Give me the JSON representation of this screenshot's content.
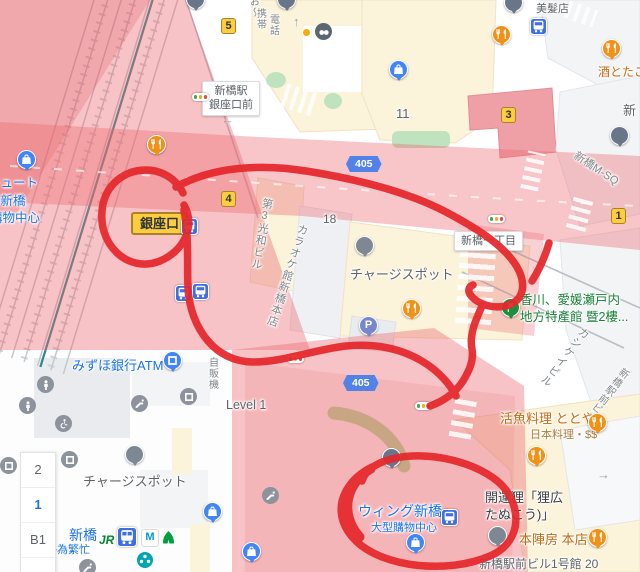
{
  "colors": {
    "annotation_red": "#E5262A",
    "pink_overlay": "#F2A6AC",
    "badge_yellow": "#FCCE3E",
    "badge_border": "#A9812A",
    "route_shield_blue": "#5282E8",
    "transit_blue": "#3F6FE0",
    "link_blue": "#1A73E8",
    "poi_gray": "#7E8894",
    "restaurant_orange": "#F09217",
    "parking_purple": "#7986CB",
    "flag_green": "#1E8E3E",
    "label_green": "#188038",
    "label_orange": "#C26A10",
    "building_cream": "#FBF3DA",
    "building_gray": "#F0F2F4"
  },
  "icons": {
    "jr": "JR",
    "metro_m": "M",
    "parking_p": "P",
    "arrow_left": "←",
    "arrow_up": "↑",
    "arrow_right": "→"
  },
  "badges": {
    "exit_ginza": "銀座口",
    "b5": "5",
    "b4": "4",
    "b3": "3",
    "b1": "1",
    "route405": "405"
  },
  "signs": {
    "station_line1": "新橋駅",
    "station_line2": "銀座口前",
    "intersection": "新橋一丁目"
  },
  "labels": {
    "bldg11": "11",
    "bldg18": "18",
    "level": "Level 1",
    "keitai_a": "お〜",
    "keitai_b": "携帯",
    "keitai_c": "電話",
    "biyoten": "美髮店",
    "sake": "酒とたこ",
    "shin_clip": "新",
    "msq": "新橋M-SQ",
    "dai3kowa": "第3光和ビル",
    "karaoke": "カラオケ館新橋本店",
    "charge1": "チャージスポット",
    "charge2": "チャージスポット",
    "kagawa1": "香川、愛媛瀬戸内",
    "kagawa2": "地方特產館 暨2樓...",
    "kashikei": "カシケイビル",
    "ekimae_v": "新橋駅前ビル",
    "katsugyo": "活魚料理 ととや",
    "nihonryori": "日本料理・$$",
    "mizuho": "みずほ銀行ATM",
    "jihanki": "自販機",
    "shinbashi_sta": "新橋",
    "busy": "略為繁忙",
    "wing": "ウィング新橋",
    "wing_sub": "大型購物中心",
    "kaiun1": "開運狸「狸広",
    "kaiun2": "たぬこう)」",
    "honjin": "本陣房 本店",
    "ekimae20": "新橋駅前ビル1号館 20",
    "left1": "チュート",
    "left2": "ン新橋",
    "left3": "購物中心"
  },
  "floors": {
    "f2": "2",
    "f1": "1",
    "fb1": "B1"
  }
}
